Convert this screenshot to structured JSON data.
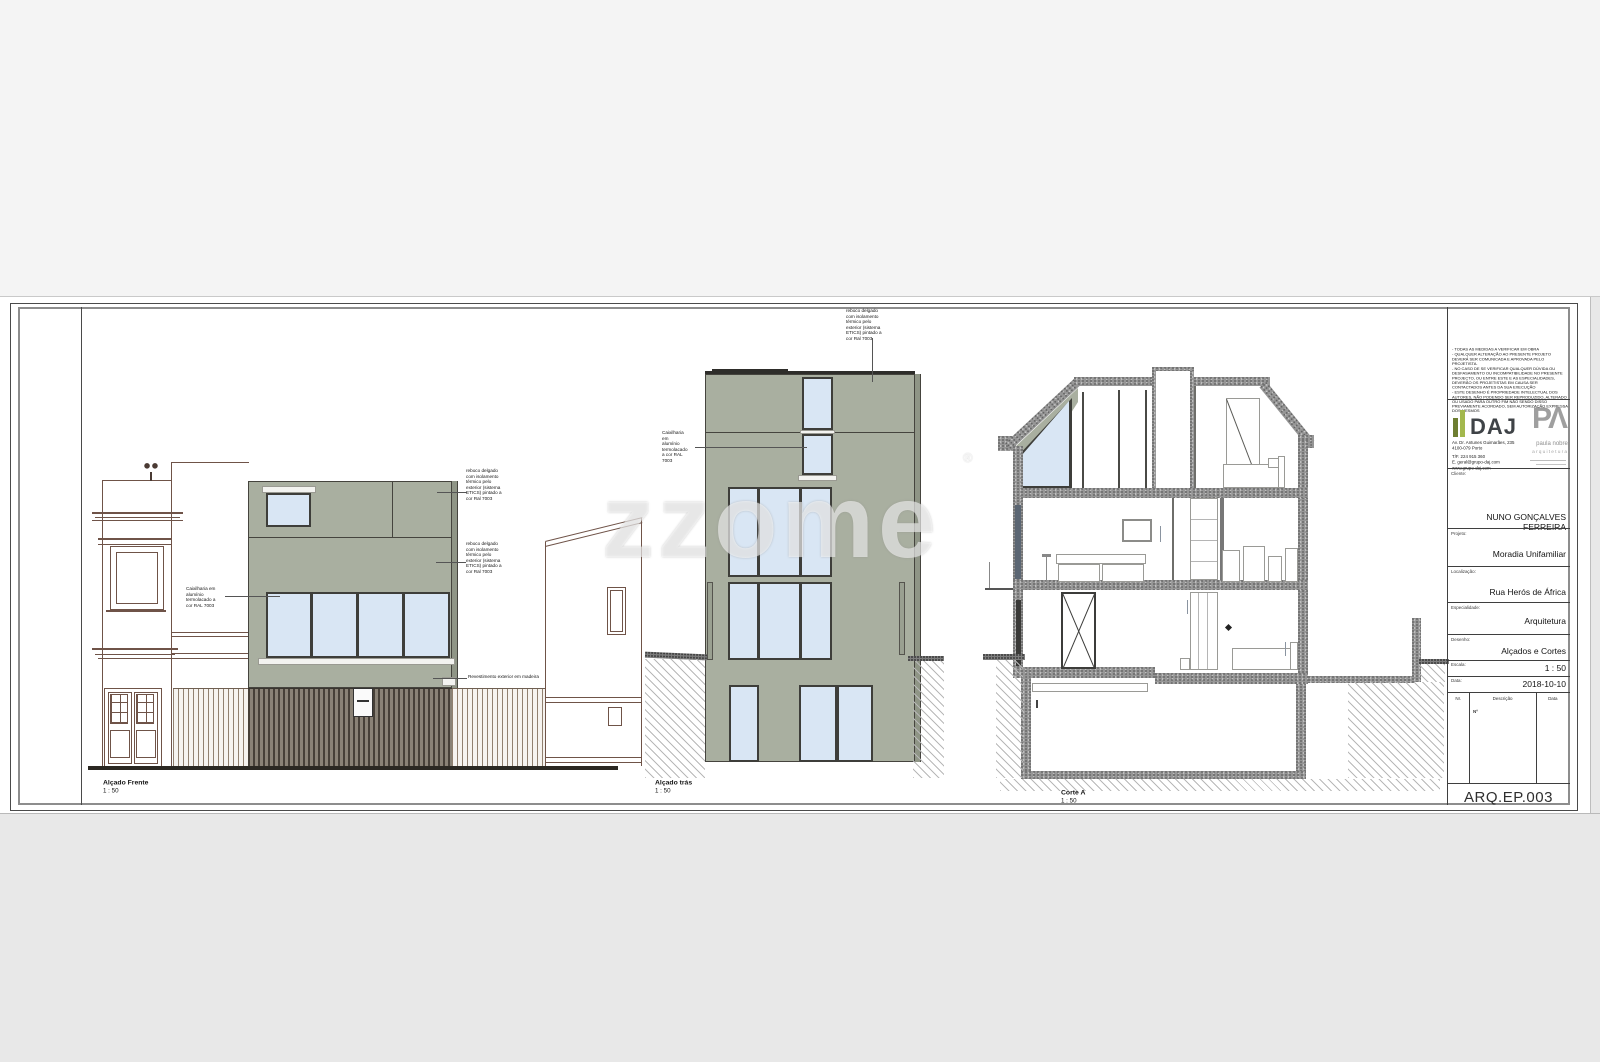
{
  "watermark": {
    "text": "zzome",
    "reg": "®"
  },
  "drawings": {
    "front": {
      "caption": "Alçado Frente",
      "scale": "1 : 50"
    },
    "rear": {
      "caption": "Alçado trás",
      "scale": "1 : 50"
    },
    "section": {
      "caption": "Corte A",
      "scale": "1 : 50"
    },
    "annotations": {
      "caixilharia": "Caixilharia em alumínio termolacado a cor RAL 7003",
      "reboco": "reboco delgado com isolamento térmico pelo exterior (sistema ETICS) pintado a cor Ral 7003",
      "madeira": "Revestimento exterior em madeira"
    }
  },
  "titleblock": {
    "notes": [
      "- TODAS AS MEDIDAS A VERIFICAR EM OBRA",
      "- QUALQUER ALTERAÇÃO AO PRESENTE PROJETO DEVERÁ SER COMUNICADA E APROVADA PELO PROJETISTA.",
      "- NO CASO DE SE VERIFICAR QUALQUER DÚVIDA OU DESFASAMENTO OU INCOMPATIBILIDADE NO PRESENTE PROJECTO, OU ENTRE ESTE E AS ESPECIALIDADES, DEVERÃO OS PROJETISTAS EM CAUSA SER CONTACTADOS ANTES DA SUA EXECUÇÃO",
      "- ESTE DESENHO É PROPRIEDADE INTELECTUAL DOS AUTORES, NÃO PODENDO SER REPRODUZIDO, ALTERADO OU USADO PARA OUTRO FIM NÃO SENDO DISSO PREVIAMENTE ACORDADO, SEM AUTORIZAÇÃO EXPRESSA DOS MESMOS"
    ],
    "daj": {
      "name": "DAJ",
      "addr1": "Av. Dr. Antunes Guimarães, 235",
      "addr2": "4100-079 Porto",
      "tel": "T/F. 224 915 360",
      "email": "E. geral@grupo-daj.com",
      "web": "www.grupo-daj.com"
    },
    "pa": {
      "logo": "PΛ",
      "name": "paula nobre",
      "sub": "arquitetura"
    },
    "fields": {
      "cliente": {
        "label": "Cliente:",
        "value": "NUNO GONÇALVES FERREIRA"
      },
      "projeto": {
        "label": "Projeto:",
        "value": "Moradia Unifamiliar"
      },
      "localizacao": {
        "label": "Localização:",
        "value": "Rua Herós de África"
      },
      "especialidade": {
        "label": "Especialidade:",
        "value": "Arquitetura"
      },
      "desenho": {
        "label": "Desenho:",
        "value": "Alçados e Cortes"
      },
      "escala": {
        "label": "Escala:",
        "value": "1 : 50"
      },
      "data": {
        "label": "Data:",
        "value": "2018-10-10"
      }
    },
    "rev": {
      "col_nr": "Nr.",
      "col_desc": "Descrição",
      "col_data": "Data",
      "entry": "Nº"
    },
    "numero": "ARQ.EP.003"
  },
  "colors": {
    "facade_green": "#a9afa0",
    "glass_blue": "#d9e6f4",
    "daj_green": "#93a83d",
    "pa_gray": "#9f9f9f"
  }
}
